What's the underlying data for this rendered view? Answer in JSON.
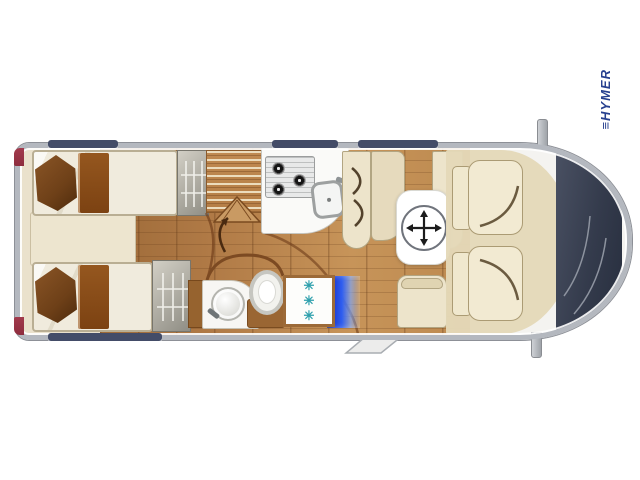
{
  "page": {
    "background_color": "#ffffff"
  },
  "cab": {
    "logo_text": "≡HYMER"
  },
  "bathroom": {
    "shower_symbol": "✳"
  },
  "vehicle": {
    "type": "motorhome-floorplan-top-view",
    "colors": {
      "brand": "#27408f",
      "body_outline": "#b4b8bf",
      "window_tint": "#434c68",
      "tail_light": "#8e2d3e",
      "wood_floor": "#b07a46",
      "furniture_cream": "#ede4cb",
      "mattress": "#f0ebdd",
      "pillow_brown": "#6e4018",
      "windshield": "#343b4c",
      "fridge_glow_blue": "#2f5ef0",
      "shower_symbol_teal": "#2fa0ad"
    },
    "icons": {
      "wardrobe": "clothes-hanger-icon",
      "table": "move-four-arrows-icon",
      "stove": "three-burner-hob-icon",
      "shower": "snowflake-icon",
      "walkway": "curved-arrow-icon"
    }
  }
}
